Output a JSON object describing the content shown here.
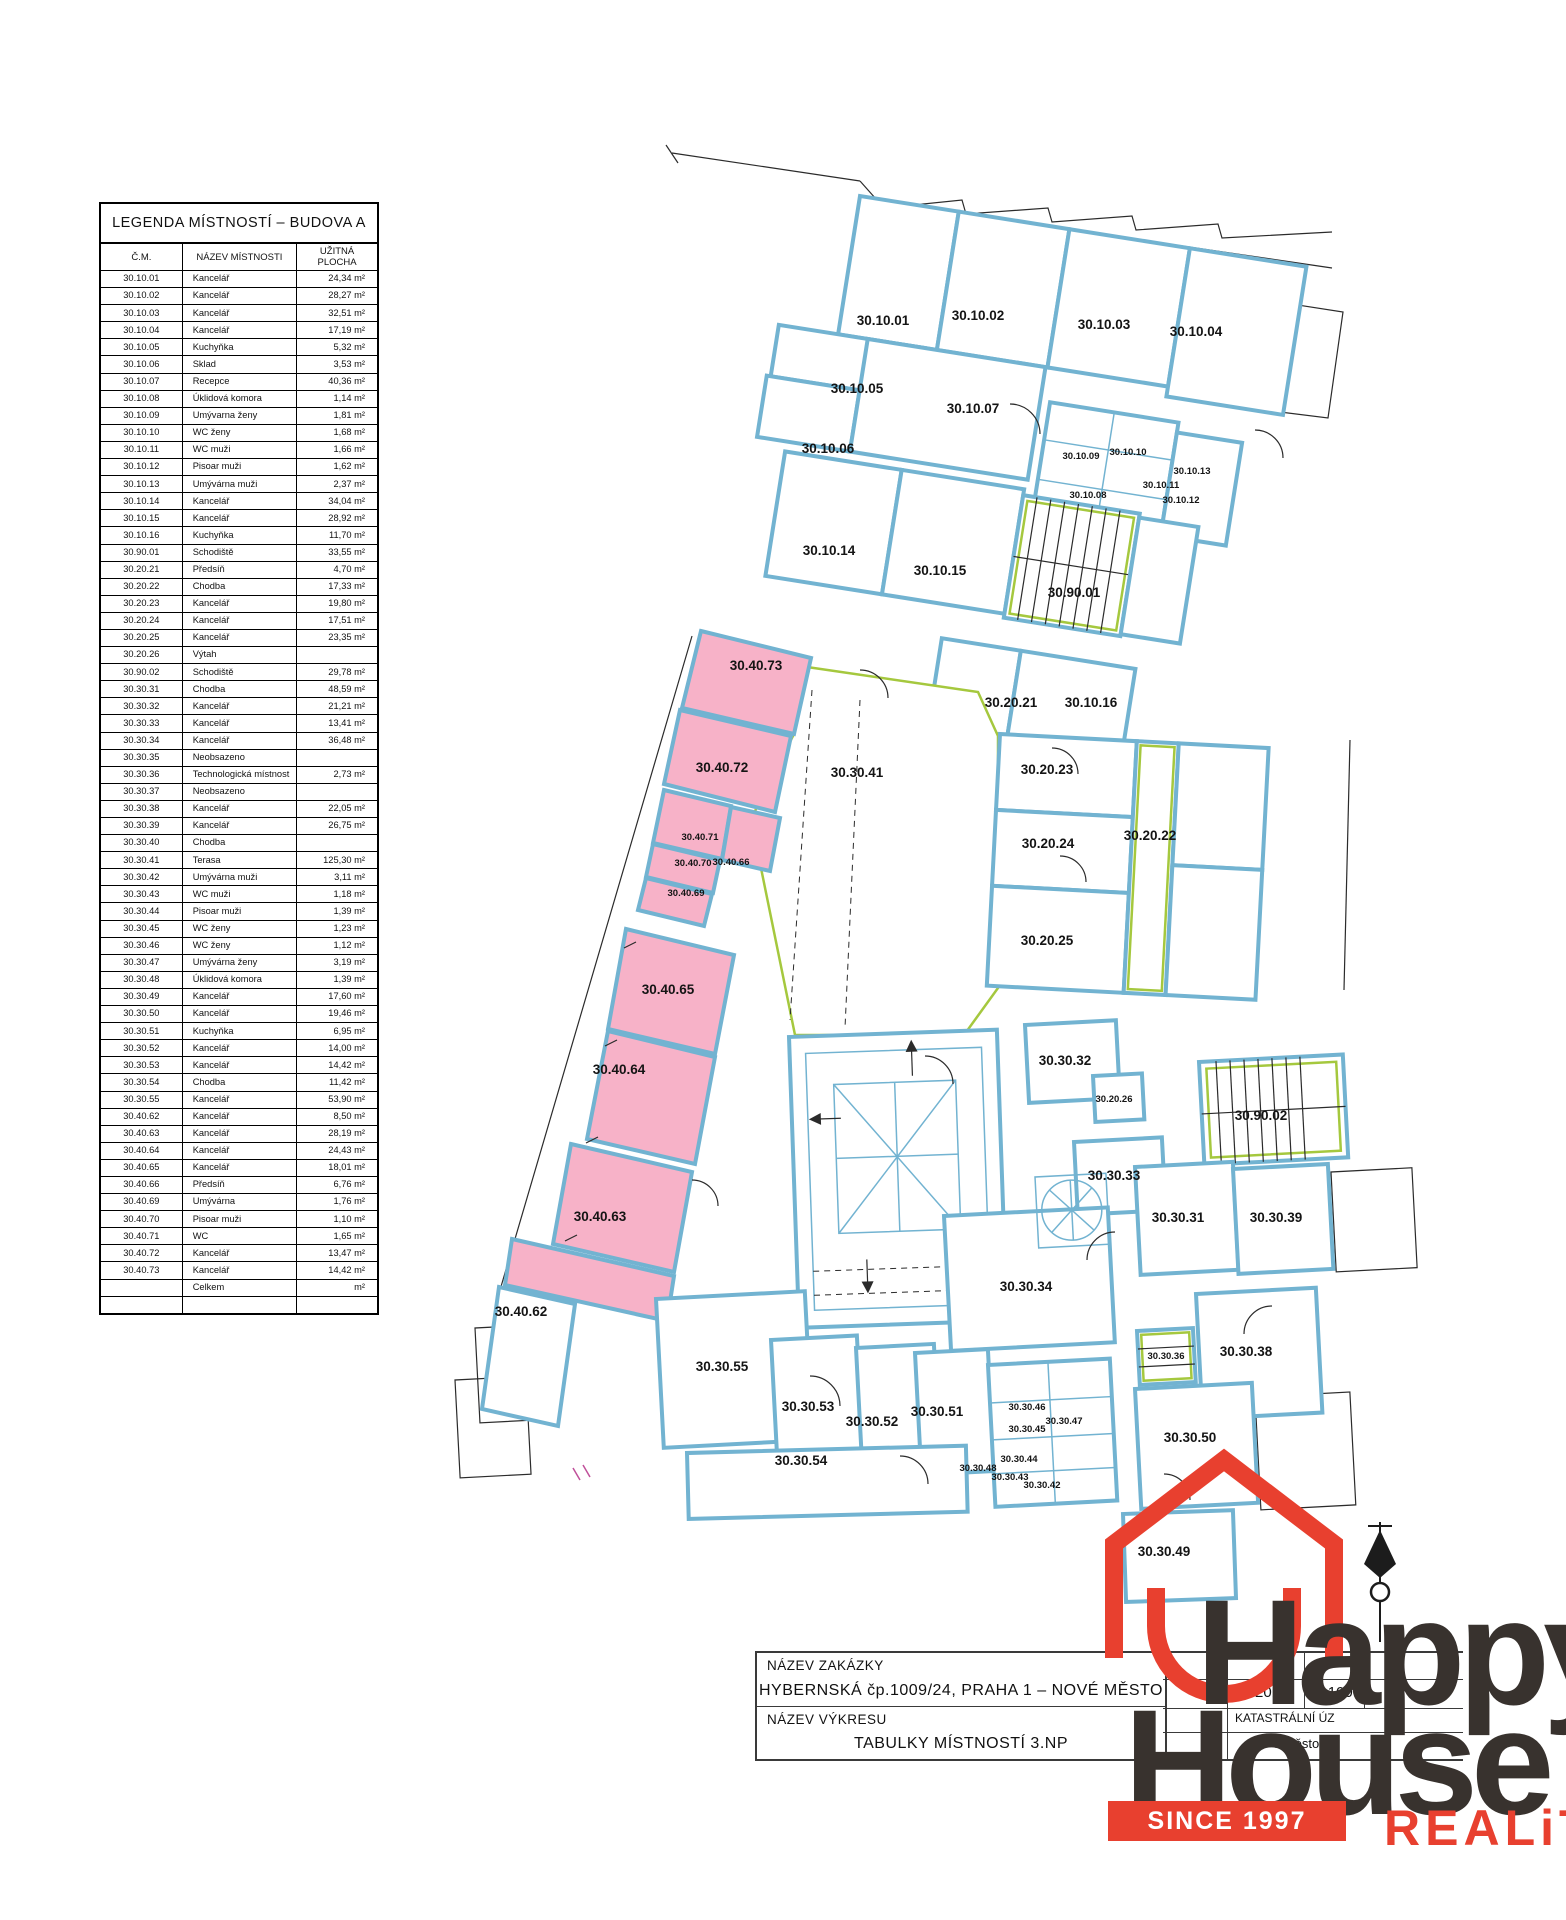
{
  "legend": {
    "title": "LEGENDA MÍSTNOSTÍ – BUDOVA A",
    "columns": [
      "Č.M.",
      "NÁZEV MÍSTNOSTI",
      "UŽITNÁ PLOCHA"
    ],
    "rows": [
      [
        "30.10.01",
        "Kancelář",
        "24,34 m²"
      ],
      [
        "30.10.02",
        "Kancelář",
        "28,27 m²"
      ],
      [
        "30.10.03",
        "Kancelář",
        "32,51 m²"
      ],
      [
        "30.10.04",
        "Kancelář",
        "17,19 m²"
      ],
      [
        "30.10.05",
        "Kuchyňka",
        "5,32 m²"
      ],
      [
        "30.10.06",
        "Sklad",
        "3,53 m²"
      ],
      [
        "30.10.07",
        "Recepce",
        "40,36 m²"
      ],
      [
        "30.10.08",
        "Úklidová komora",
        "1,14 m²"
      ],
      [
        "30.10.09",
        "Umývarna ženy",
        "1,81 m²"
      ],
      [
        "30.10.10",
        "WC ženy",
        "1,68 m²"
      ],
      [
        "30.10.11",
        "WC muži",
        "1,66 m²"
      ],
      [
        "30.10.12",
        "Pisoar muži",
        "1,62 m²"
      ],
      [
        "30.10.13",
        "Umývárna muži",
        "2,37 m²"
      ],
      [
        "30.10.14",
        "Kancelář",
        "34,04 m²"
      ],
      [
        "30.10.15",
        "Kancelář",
        "28,92 m²"
      ],
      [
        "30.10.16",
        "Kuchyňka",
        "11,70 m²"
      ],
      [
        "30.90.01",
        "Schodiště",
        "33,55 m²"
      ],
      [
        "30.20.21",
        "Předsíň",
        "4,70 m²"
      ],
      [
        "30.20.22",
        "Chodba",
        "17,33 m²"
      ],
      [
        "30.20.23",
        "Kancelář",
        "19,80 m²"
      ],
      [
        "30.20.24",
        "Kancelář",
        "17,51 m²"
      ],
      [
        "30.20.25",
        "Kancelář",
        "23,35 m²"
      ],
      [
        "30.20.26",
        "Výtah",
        ""
      ],
      [
        "30.90.02",
        "Schodiště",
        "29,78 m²"
      ],
      [
        "30.30.31",
        "Chodba",
        "48,59 m²"
      ],
      [
        "30.30.32",
        "Kancelář",
        "21,21 m²"
      ],
      [
        "30.30.33",
        "Kancelář",
        "13,41 m²"
      ],
      [
        "30.30.34",
        "Kancelář",
        "36,48 m²"
      ],
      [
        "30.30.35",
        "Neobsazeno",
        ""
      ],
      [
        "30.30.36",
        "Technologická místnost",
        "2,73 m²"
      ],
      [
        "30.30.37",
        "Neobsazeno",
        ""
      ],
      [
        "30.30.38",
        "Kancelář",
        "22,05 m²"
      ],
      [
        "30.30.39",
        "Kancelář",
        "26,75 m²"
      ],
      [
        "30.30.40",
        "Chodba",
        ""
      ],
      [
        "30.30.41",
        "Terasa",
        "125,30 m²"
      ],
      [
        "30.30.42",
        "Umývárna muži",
        "3,11 m²"
      ],
      [
        "30.30.43",
        "WC muži",
        "1,18 m²"
      ],
      [
        "30.30.44",
        "Pisoar muži",
        "1,39 m²"
      ],
      [
        "30.30.45",
        "WC ženy",
        "1,23 m²"
      ],
      [
        "30.30.46",
        "WC ženy",
        "1,12 m²"
      ],
      [
        "30.30.47",
        "Umývárna ženy",
        "3,19 m²"
      ],
      [
        "30.30.48",
        "Úklidová komora",
        "1,39 m²"
      ],
      [
        "30.30.49",
        "Kancelář",
        "17,60 m²"
      ],
      [
        "30.30.50",
        "Kancelář",
        "19,46 m²"
      ],
      [
        "30.30.51",
        "Kuchyňka",
        "6,95 m²"
      ],
      [
        "30.30.52",
        "Kancelář",
        "14,00 m²"
      ],
      [
        "30.30.53",
        "Kancelář",
        "14,42 m²"
      ],
      [
        "30.30.54",
        "Chodba",
        "11,42 m²"
      ],
      [
        "30.30.55",
        "Kancelář",
        "53,90 m²"
      ],
      [
        "30.40.62",
        "Kancelář",
        "8,50 m²"
      ],
      [
        "30.40.63",
        "Kancelář",
        "28,19 m²"
      ],
      [
        "30.40.64",
        "Kancelář",
        "24,43 m²"
      ],
      [
        "30.40.65",
        "Kancelář",
        "18,01 m²"
      ],
      [
        "30.40.66",
        "Předsíň",
        "6,76 m²"
      ],
      [
        "30.40.69",
        "Umývárna",
        "1,76 m²"
      ],
      [
        "30.40.70",
        "Pisoar muži",
        "1,10 m²"
      ],
      [
        "30.40.71",
        "WC",
        "1,65 m²"
      ],
      [
        "30.40.72",
        "Kancelář",
        "13,47 m²"
      ],
      [
        "30.40.73",
        "Kancelář",
        "14,42 m²"
      ],
      [
        "",
        "Celkem",
        "m²"
      ],
      [
        "",
        "",
        ""
      ]
    ]
  },
  "plan": {
    "colors": {
      "wall": "#72b3d1",
      "highlight": "#f7b2c8",
      "stairs": "#a5c83e",
      "line": "#2b2b2b"
    },
    "rooms": [
      [
        "30.10.01",
        883,
        325
      ],
      [
        "30.10.02",
        978,
        320
      ],
      [
        "30.10.03",
        1104,
        329
      ],
      [
        "30.10.04",
        1196,
        336
      ],
      [
        "30.10.05",
        857,
        393
      ],
      [
        "30.10.06",
        828,
        453
      ],
      [
        "30.10.07",
        973,
        413
      ],
      [
        "30.10.09",
        1081,
        459,
        1
      ],
      [
        "30.10.10",
        1128,
        455,
        1
      ],
      [
        "30.10.08",
        1088,
        498,
        1
      ],
      [
        "30.10.11",
        1161,
        488,
        1
      ],
      [
        "30.10.12",
        1181,
        503,
        1
      ],
      [
        "30.10.13",
        1192,
        474,
        1
      ],
      [
        "30.10.14",
        829,
        555
      ],
      [
        "30.10.15",
        940,
        575
      ],
      [
        "30.90.01",
        1074,
        597
      ],
      [
        "30.20.21",
        1011,
        707
      ],
      [
        "30.10.16",
        1091,
        707
      ],
      [
        "30.40.73",
        756,
        670
      ],
      [
        "30.20.23",
        1047,
        774
      ],
      [
        "30.40.72",
        722,
        772
      ],
      [
        "30.30.41",
        857,
        777
      ],
      [
        "30.20.22",
        1150,
        840
      ],
      [
        "30.20.24",
        1048,
        848
      ],
      [
        "30.40.71",
        700,
        840,
        1
      ],
      [
        "30.40.70",
        693,
        866,
        1
      ],
      [
        "30.40.66",
        731,
        865,
        1
      ],
      [
        "30.40.69",
        686,
        896,
        1
      ],
      [
        "30.20.25",
        1047,
        945
      ],
      [
        "30.40.65",
        668,
        994
      ],
      [
        "30.30.32",
        1065,
        1065
      ],
      [
        "30.20.26",
        1114,
        1102,
        1
      ],
      [
        "30.90.02",
        1261,
        1120
      ],
      [
        "30.40.64",
        619,
        1074
      ],
      [
        "30.30.33",
        1114,
        1180
      ],
      [
        "30.30.31",
        1178,
        1222
      ],
      [
        "30.30.39",
        1276,
        1222
      ],
      [
        "30.40.63",
        600,
        1221
      ],
      [
        "30.30.34",
        1026,
        1291
      ],
      [
        "30.30.38",
        1246,
        1356
      ],
      [
        "30.30.36",
        1166,
        1359,
        1
      ],
      [
        "30.40.62",
        521,
        1316
      ],
      [
        "30.30.55",
        722,
        1371
      ],
      [
        "30.30.53",
        808,
        1411
      ],
      [
        "30.30.52",
        872,
        1426
      ],
      [
        "30.30.51",
        937,
        1416
      ],
      [
        "30.30.46",
        1027,
        1410,
        1
      ],
      [
        "30.30.47",
        1064,
        1424,
        1
      ],
      [
        "30.30.45",
        1027,
        1432,
        1
      ],
      [
        "30.30.50",
        1190,
        1442
      ],
      [
        "30.30.44",
        1019,
        1462,
        1
      ],
      [
        "30.30.48",
        978,
        1471,
        1
      ],
      [
        "30.30.43",
        1010,
        1480,
        1
      ],
      [
        "30.30.42",
        1042,
        1488,
        1
      ],
      [
        "30.30.54",
        801,
        1465
      ],
      [
        "30.30.49",
        1164,
        1556
      ]
    ]
  },
  "titleblock": {
    "label1": "NÁZEV ZAKÁZKY",
    "value1": "HYBERNSKÁ čp.1009/24, PRAHA 1 – NOVÉ MĚSTO",
    "label2": "NÁZEV VÝKRESU",
    "value2": "TABULKY MÍSTNOSTÍ 3.NP",
    "date": "1/2016",
    "scale": "1:100",
    "dash": "—",
    "partial1": "KATASTRÁLNÍ ÚZ",
    "partial2": "é Město"
  },
  "logo": {
    "word1": "Happy",
    "word2": "House",
    "since": "SINCE 1997",
    "reality": "REALiTY",
    "red": "#e8402f",
    "dark": "#38322e"
  }
}
